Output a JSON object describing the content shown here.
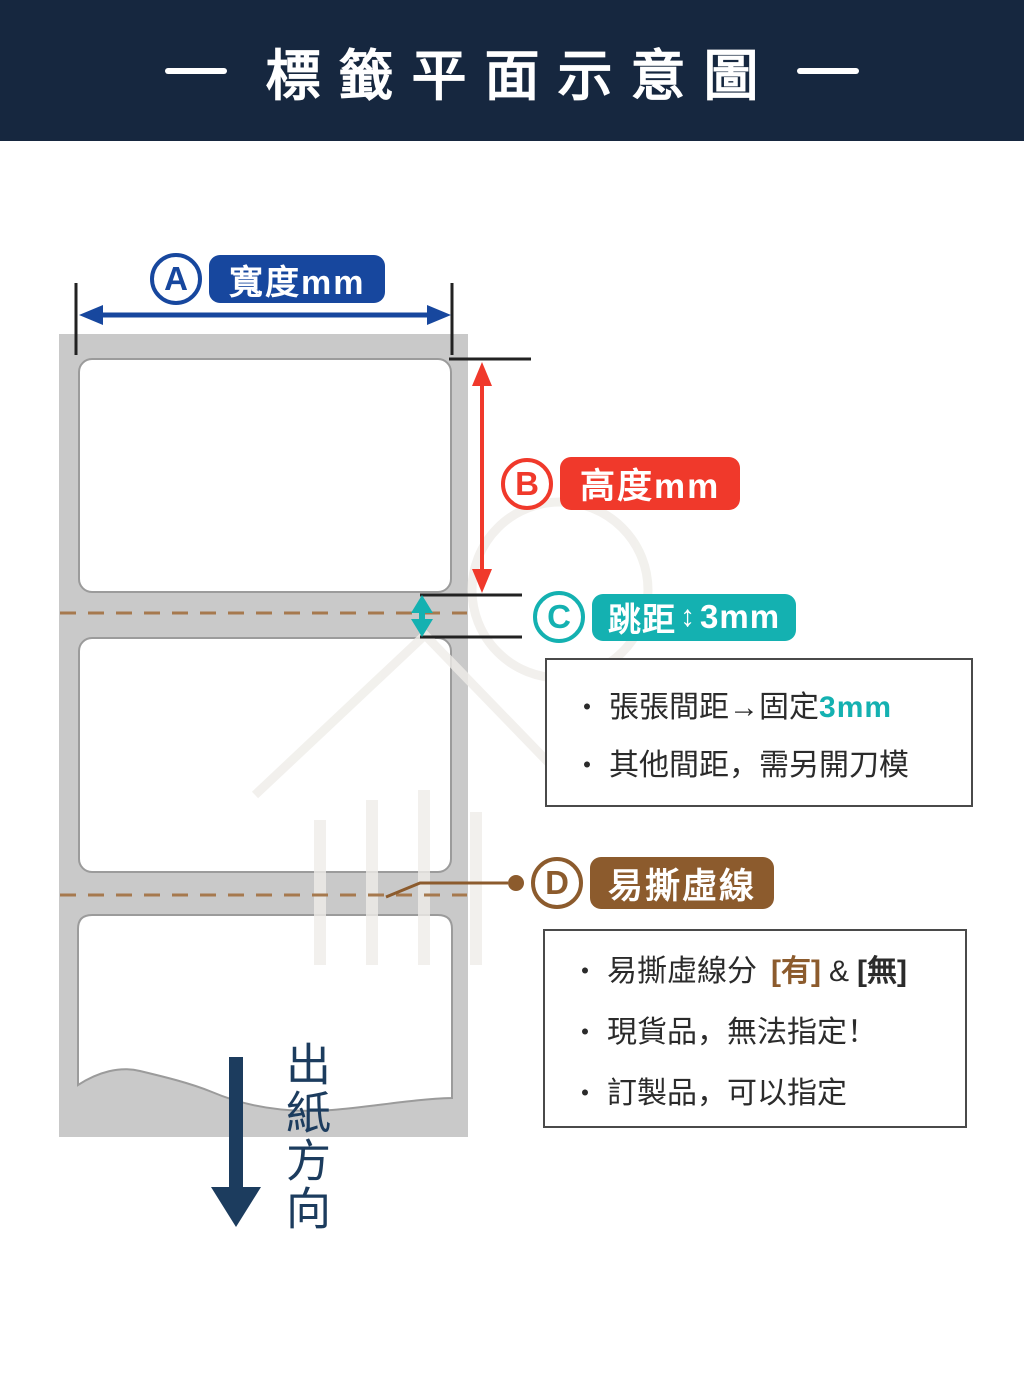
{
  "header": {
    "title": "標籤平面示意圖"
  },
  "callouts": {
    "a": {
      "letter": "A",
      "label": "寬度mm"
    },
    "b": {
      "letter": "B",
      "label": "高度mm"
    },
    "c": {
      "letter": "C",
      "label_prefix": "跳距",
      "arrow_glyph": "↕",
      "label_value": "3mm"
    },
    "d": {
      "letter": "D",
      "label": "易撕虛線"
    }
  },
  "notes": {
    "bullet": "・",
    "gap_box": {
      "line1_text": "張張間距→固定",
      "line1_highlight": "3mm",
      "line2_text": "其他間距，需另開刀模"
    },
    "perforation_box": {
      "line1_text": "易撕虛線分",
      "line1_tag_yes": "[有]",
      "line1_amp": "&",
      "line1_tag_no": "[無]",
      "line2_text": "現貨品，無法指定！",
      "line3_text": "訂製品，可以指定"
    }
  },
  "paper_output": {
    "text": "出紙方向"
  },
  "colors": {
    "header_bg": "#16273F",
    "width_blue": "#17479E",
    "height_red": "#F0392B",
    "gap_teal": "#14B1B1",
    "perforation_brown": "#8C5B2D",
    "backing_gray": "#C9C9C9",
    "arrow_navy": "#1C3C5E",
    "dash_line_brown": "#A6794E"
  }
}
